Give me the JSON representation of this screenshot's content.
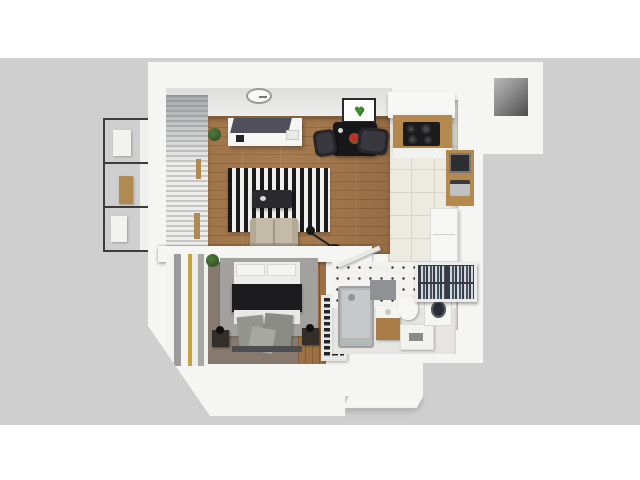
{
  "scene": {
    "kind": "3d-apartment-floorplan-render",
    "palette": {
      "backdrop": "#cfcfcf",
      "wall": "#f5f5f3",
      "wood_floor": "#a87c50",
      "wood_counter": "#b5894e",
      "tile_floor": "#edeae2",
      "bath_tile": "#f3f2ef",
      "bedroom_floor": "#867a6e",
      "rug_black": "#1a1a1a",
      "rug_white": "#efefed",
      "sofa": "#c4baa8",
      "blanket": "#1c1c1f",
      "accent_green": "#3e8e2d",
      "accent_red": "#c03028",
      "metal": "#bfc1c3"
    },
    "art": {
      "heart_glyph": "♥"
    },
    "rooms": [
      {
        "name": "living-room",
        "floor": "wood-planks",
        "items": [
          "striped-rug",
          "beige-sofa",
          "coffee-table",
          "tv-sideboard",
          "wall-clock",
          "moss-heart-art",
          "floor-lamp",
          "dining-table",
          "dining-chairs",
          "plants",
          "window-blinds"
        ]
      },
      {
        "name": "kitchen",
        "floor": "cream-tiles",
        "items": [
          "upper-cabinets",
          "wood-counter",
          "black-cooktop",
          "built-in-oven",
          "coffee-machine",
          "tall-cabinet"
        ]
      },
      {
        "name": "hallway",
        "items": [
          "open-wardrobe-with-clothes",
          "wall-niche"
        ]
      },
      {
        "name": "bathroom",
        "floor": "light-tiles",
        "items": [
          "dot-accent-tiles",
          "bathtub",
          "vanity-sink",
          "mirror-panel",
          "toilet",
          "washing-machine",
          "low-cabinet",
          "open-door"
        ]
      },
      {
        "name": "bedroom",
        "floor": "taupe-carpet",
        "items": [
          "double-bed",
          "black-blanket",
          "gray-pillows",
          "nightstands",
          "ball-lamps",
          "gray-rug",
          "curtain-wall",
          "wood-accent-wall",
          "plant"
        ]
      },
      {
        "name": "exterior",
        "items": [
          "balcony-frame",
          "shadow"
        ]
      }
    ],
    "storage": [
      "wine-rack"
    ]
  }
}
